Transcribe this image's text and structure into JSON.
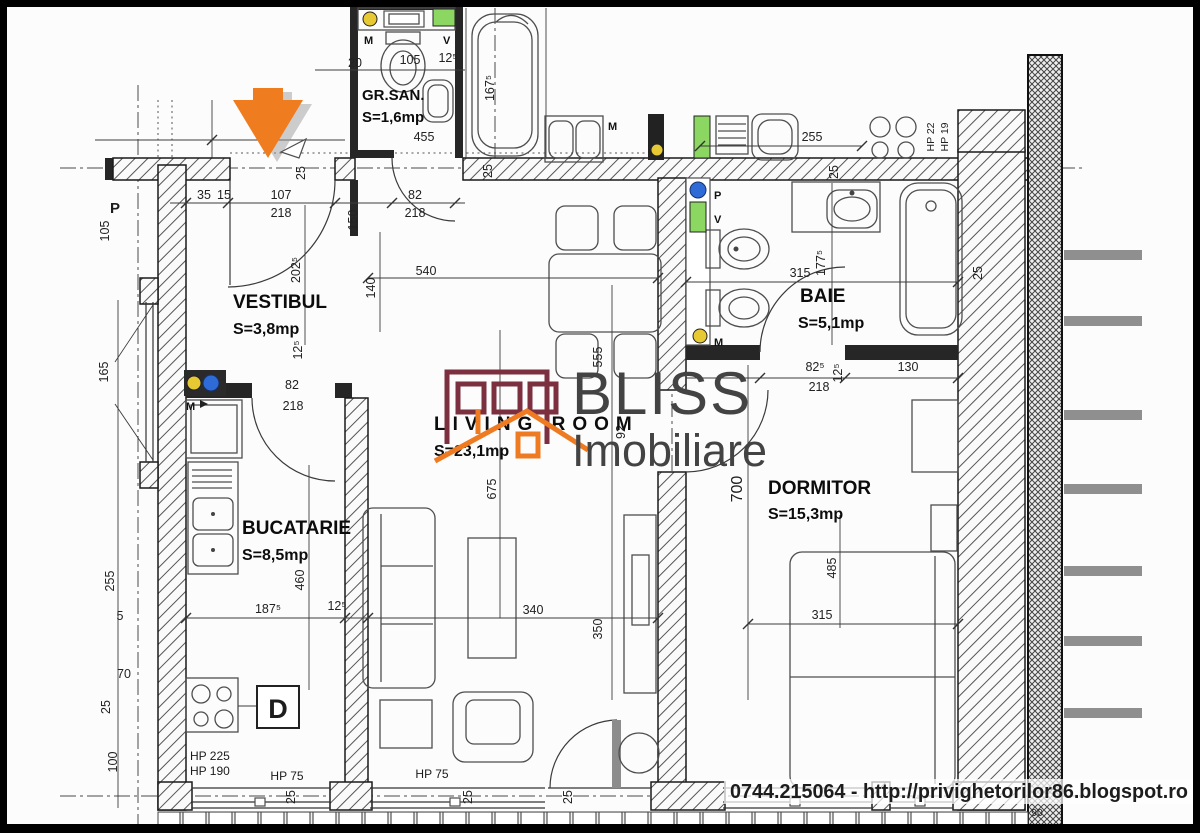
{
  "page": {
    "type": "apartment-floor-plan"
  },
  "rooms": {
    "vestibul": {
      "name": "VESTIBUL",
      "area": "S=3,8mp"
    },
    "gr_san": {
      "name": "GR.SAN.",
      "area": "S=1,6mp"
    },
    "baie": {
      "name": "BAIE",
      "area": "S=5,1mp"
    },
    "living": {
      "name": "LIVING ROOM",
      "area": "S=23,1mp"
    },
    "bucatarie": {
      "name": "BUCATARIE",
      "area": "S=8,5mp"
    },
    "dormitor": {
      "name": "DORMITOR",
      "area": "S=15,3mp"
    }
  },
  "dims": {
    "d35": "35",
    "d15": "15",
    "d107": "107",
    "d218": "218",
    "d82": "82",
    "d82_5": "82⁵",
    "d20": "20",
    "d105": "105",
    "d12_5": "12⁵",
    "d455": "455",
    "d167_5": "167⁵",
    "d540": "540",
    "d140": "140",
    "d150": "150",
    "d202_5": "202⁵",
    "d255": "255",
    "d315": "315",
    "d177_5": "177⁵",
    "d130": "130",
    "d700": "700",
    "d485": "485",
    "d460": "460",
    "d187_5": "187⁵",
    "d340": "340",
    "d350": "350",
    "d675": "675",
    "d555": "555",
    "d92": "92",
    "d165": "165",
    "d5": "5",
    "d70": "70",
    "d100": "100",
    "d25": "25",
    "d90": "90"
  },
  "annotations": {
    "hp225": "HP 225",
    "hp190": "HP 190",
    "hp75": "HP 75",
    "hp22": "HP 22",
    "hp19": "HP 19",
    "stove_zone": "D",
    "meter_m": "M",
    "vent_v": "V",
    "pipe_p": "P"
  },
  "watermark": {
    "brand_line1": "BLISS",
    "brand_line2": "Imobiliare",
    "logo_dark_color": "#7c2f3f",
    "logo_orange_color": "#ee7b22"
  },
  "entrance_marker": {
    "color": "#ef7c1e"
  },
  "contact": {
    "text": "0744.215064 - http://privighetorilor86.blogspot.ro"
  }
}
